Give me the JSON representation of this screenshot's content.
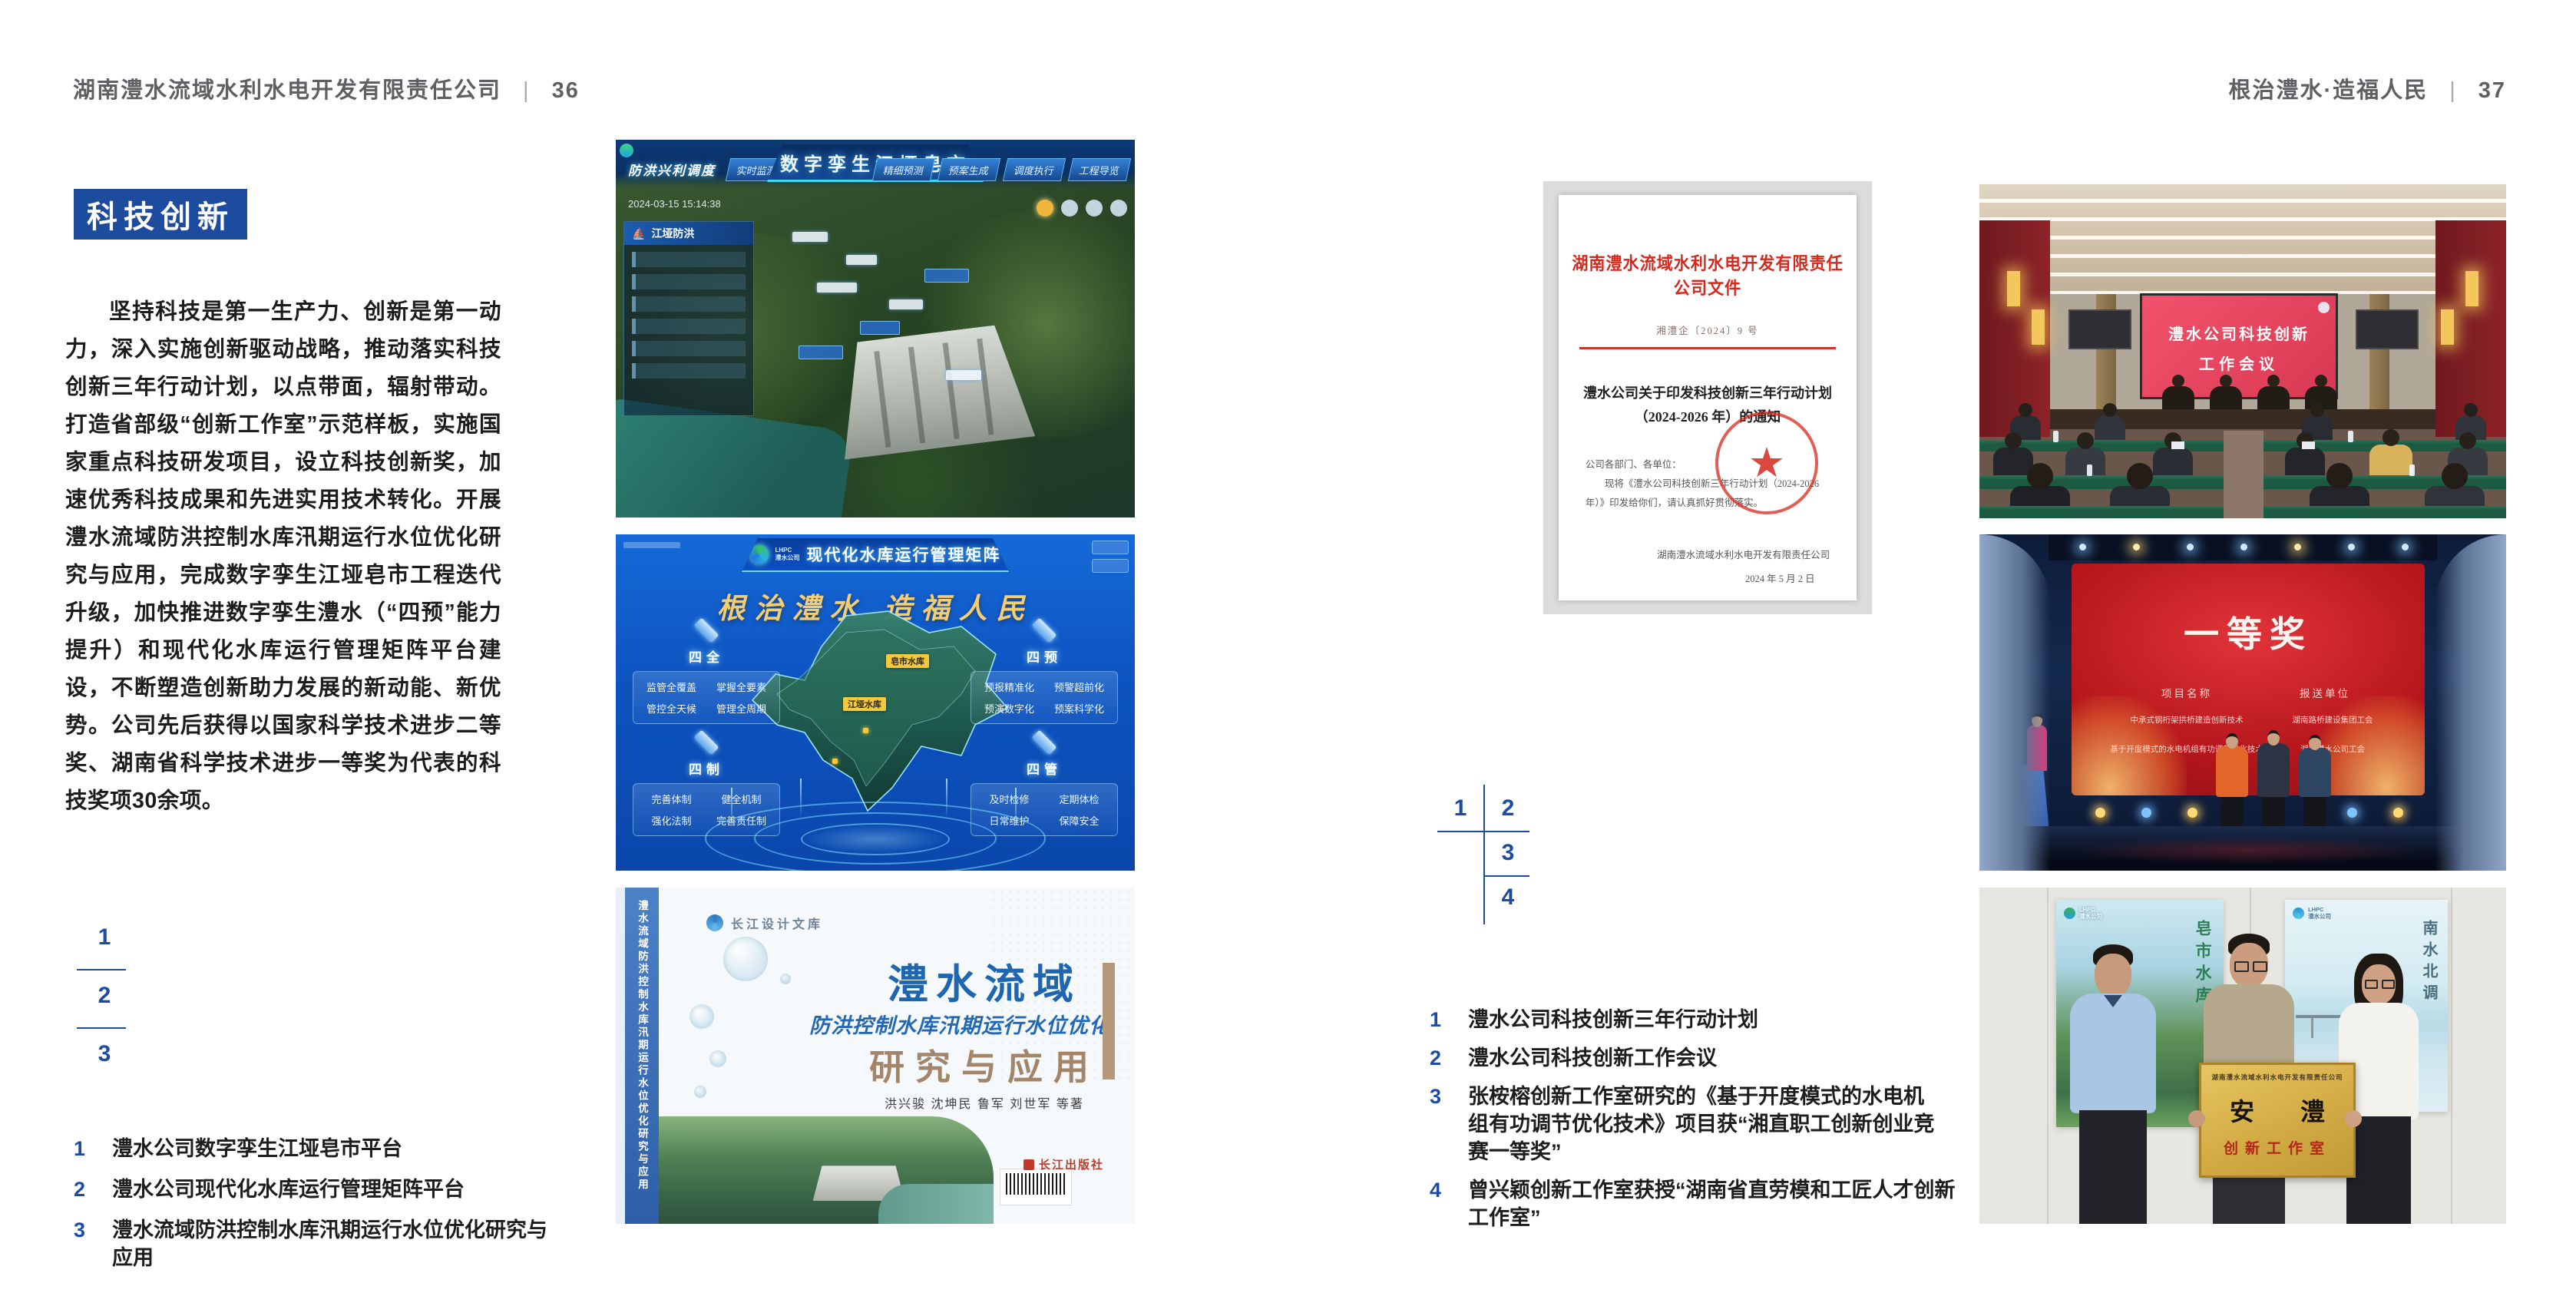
{
  "header_left": {
    "company": "湖南澧水流域水利水电开发有限责任公司",
    "divider": "|",
    "page": "36"
  },
  "header_right": {
    "slogan": "根治澧水·造福人民",
    "divider": "|",
    "page": "37"
  },
  "left_page": {
    "badge": "科技创新",
    "body": "坚持科技是第一生产力、创新是第一动力，深入实施创新驱动战略，推动落实科技创新三年行动计划，以点带面，辐射带动。打造省部级“创新工作室”示范样板，实施国家重点科技研发项目，设立科技创新奖，加速优秀科技成果和先进实用技术转化。开展澧水流域防洪控制水库汛期运行水位优化研究与应用，完成数字孪生江垭皂市工程迭代升级，加快推进数字孪生澧水（“四预”能力提升）和现代化水库运行管理矩阵平台建设，不断塑造创新助力发展的新动能、新优势。公司先后获得以国家科学技术进步二等奖、湖南省科学技术进步一等奖为代表的科技奖项30余项。",
    "nums": [
      "1",
      "2",
      "3"
    ],
    "captions": [
      {
        "num": "1",
        "text": "澧水公司数字孪生江垭皂市平台"
      },
      {
        "num": "2",
        "text": "澧水公司现代化水库运行管理矩阵平台"
      },
      {
        "num": "3",
        "text": "澧水流域防洪控制水库汛期运行水位优化研究与应用"
      }
    ]
  },
  "right_page": {
    "nums": [
      "1",
      "2",
      "3",
      "4"
    ],
    "captions": [
      {
        "num": "1",
        "text": "澧水公司科技创新三年行动计划"
      },
      {
        "num": "2",
        "text": "澧水公司科技创新工作会议"
      },
      {
        "num": "3",
        "text": "张桉榕创新工作室研究的《基于开度模式的水电机组有功调节优化技术》项目获“湘直职工创新创业竞赛一等奖”"
      },
      {
        "num": "4",
        "text": "曾兴颖创新工作室获授“湖南省直劳模和工匠人才创新工作室”"
      }
    ]
  },
  "dashboard": {
    "corner_label": "防洪兴利调度",
    "title": "数字孪生江垭皂市",
    "nav_left": [
      "实时监测",
      "洪水预报",
      "防洪预警"
    ],
    "nav_right": [
      "精细预测",
      "预案生成",
      "调度执行",
      "工程导览"
    ],
    "timestamp": "2024-03-15 15:14:38",
    "panel_title": "江垭防洪"
  },
  "matrix": {
    "logo_text": "LHPC",
    "logo_sub": "澧水公司",
    "title": "现代化水库运行管理矩阵",
    "slogan": "根治澧水 造福人民",
    "panels": [
      {
        "name": "四全",
        "items": [
          "监管全覆盖",
          "掌握全要素",
          "管控全天候",
          "管理全周期"
        ]
      },
      {
        "name": "四预",
        "items": [
          "预报精准化",
          "预警超前化",
          "预演数字化",
          "预案科学化"
        ]
      },
      {
        "name": "四制",
        "items": [
          "完善体制",
          "健全机制",
          "强化法制",
          "完善责任制"
        ]
      },
      {
        "name": "四管",
        "items": [
          "及时检修",
          "定期体检",
          "日常维护",
          "保障安全"
        ]
      }
    ],
    "marker1": "皂市水库",
    "marker2": "江垭水库"
  },
  "book": {
    "library": "长江设计文库",
    "title_main": "澧水流域",
    "title_sub": "防洪控制水库汛期运行水位优化",
    "title_tail": "研究与应用",
    "authors": "洪兴骏 沈坤民 鲁军 刘世军 等著",
    "spine": "澧水流域防洪控制水库汛期运行水位优化研究与应用",
    "publisher": "长江出版社"
  },
  "document": {
    "header": "湖南澧水流域水利水电开发有限责任公司文件",
    "doc_no": "湘澧企〔2024〕9 号",
    "title_line1": "澧水公司关于印发科技创新三年行动计划",
    "title_line2": "（2024-2026 年）的通知",
    "salutation": "公司各部门、各单位：",
    "body_line": "现将《澧水公司科技创新三年行动计划（2024-2026 年）》印发给你们，请认真抓好贯彻落实。",
    "signature": "湖南澧水流域水利水电开发有限责任公司",
    "date": "2024 年 5 月 2 日"
  },
  "meeting": {
    "screen_line1": "澧水公司科技创新",
    "screen_line2": "工作会议"
  },
  "award": {
    "title": "一等奖",
    "col1": "项目名称",
    "col2": "报送单位",
    "rows": [
      {
        "project": "中承式钢桁架拱桥建造创新技术",
        "unit": "湖南路桥建设集团工会"
      },
      {
        "project": "基于开度模式的水电机组有功调节优化技术",
        "unit": "湖南澧水公司工会"
      }
    ]
  },
  "group": {
    "plaque_org": "湖南澧水流域水利水电开发有限责任公司",
    "plaque_name": "安 澧",
    "plaque_sub": "创新工作室",
    "poster_left_text": "皂市水库",
    "poster_right_text": "南水北调",
    "poster_logo": "LHPC",
    "poster_logo_sub": "澧水公司"
  }
}
